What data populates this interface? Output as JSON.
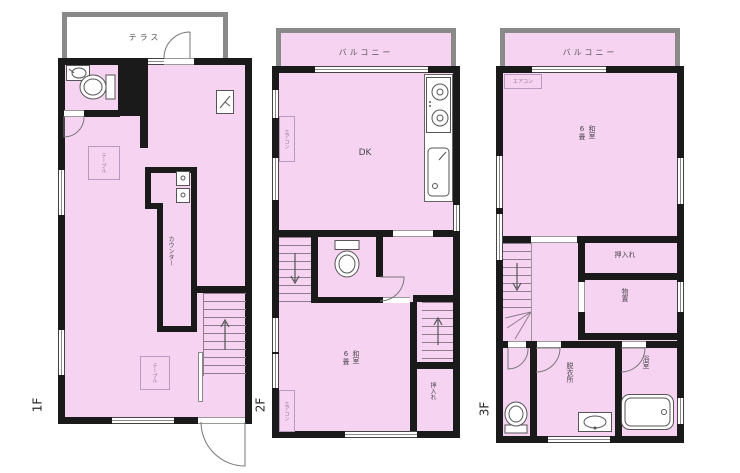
{
  "colors": {
    "room_fill": "#f7d3f2",
    "wall": "#1a1a1a",
    "outdoor_wall": "#8a8a8a",
    "fixture_stroke": "#555555",
    "label_text": "#4a4a4a"
  },
  "floor1": {
    "label": "1F",
    "terrace_label": "テラス",
    "counter_label": "カウンター",
    "table1_label": "テーブル",
    "table2_label": "テーブル"
  },
  "floor2": {
    "label": "2F",
    "balcony_label": "バルコニー",
    "dk_label": "DK",
    "washitsu_label": "和室",
    "washitsu_size": "6畳",
    "oshiire_label": "押入れ",
    "aircon1_label": "エアコン",
    "aircon2_label": "エアコン"
  },
  "floor3": {
    "label": "3F",
    "balcony_label": "バルコニー",
    "aircon_label": "エアコン",
    "washitsu_label": "和室",
    "washitsu_size": "6畳",
    "oshiire_label": "押入れ",
    "monooki_label": "物置",
    "datsuiishitsu_label": "脱衣所",
    "yokushitsu_label": "浴室"
  }
}
